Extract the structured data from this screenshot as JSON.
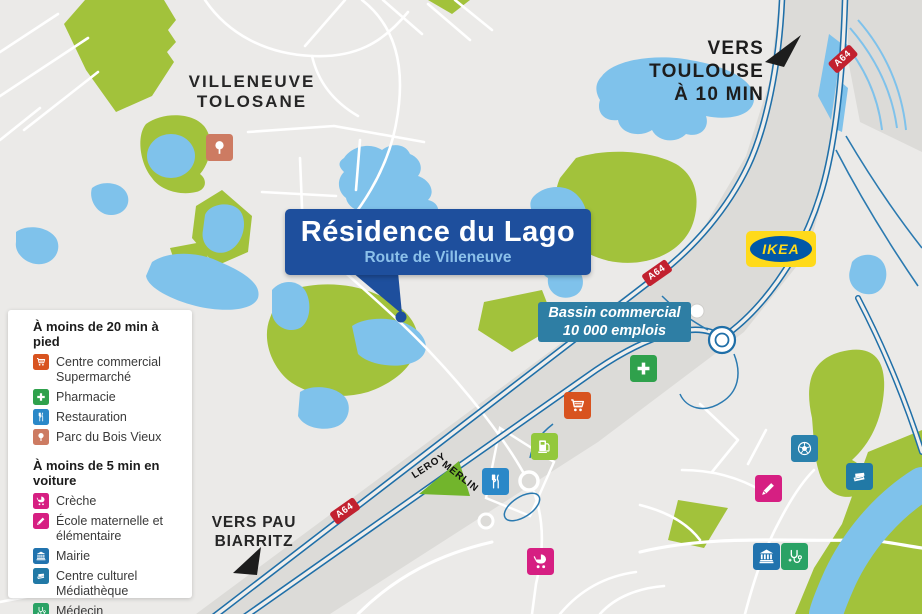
{
  "colors": {
    "land": "#EBEAE8",
    "corridor": "#DCDBD8",
    "water": "#7FC2EB",
    "park": "#A2C23B",
    "road": "#FFFFFF",
    "motorway": "#1F6FA8",
    "ramp": "#2B7AB0",
    "badge_red": "#C2212F",
    "callout_bg": "#1E4F9D",
    "callout_subtitle": "#8BC0EA",
    "bassin_bg": "#2E7EA4",
    "ikea_yellow": "#FFDA1A",
    "ikea_blue": "#0058A8",
    "leroy_green": "#72B52C"
  },
  "callout": {
    "title": "Résidence du Lago",
    "subtitle": "Route de Villeneuve"
  },
  "labels": {
    "city": "VILLENEUVE\nTOLOSANE",
    "toulouse": "VERS TOULOUSE\nÀ 10 MIN",
    "pau": "VERS PAU\nBIARRITZ"
  },
  "bassin": {
    "line1": "Bassin commercial",
    "line2": "10 000 emplois"
  },
  "brands": {
    "ikea": "IKEA",
    "leroy": "LEROY",
    "merlin": "MERLIN"
  },
  "map": {
    "badges": [
      {
        "label": "A64",
        "x": 345,
        "y": 511,
        "rot": -35
      },
      {
        "label": "A64",
        "x": 657,
        "y": 273,
        "rot": -35
      },
      {
        "label": "A64",
        "x": 843,
        "y": 59,
        "rot": -42
      }
    ],
    "markers": [
      {
        "icon": "tree",
        "color": "#CD7B62",
        "x": 206,
        "y": 134
      },
      {
        "icon": "cart",
        "color": "#D8531F",
        "x": 564,
        "y": 392
      },
      {
        "icon": "cross",
        "color": "#2FA14C",
        "x": 630,
        "y": 355
      },
      {
        "icon": "fuel",
        "color": "#93C83D",
        "x": 531,
        "y": 433
      },
      {
        "icon": "restaurant",
        "color": "#2A88C8",
        "x": 482,
        "y": 468
      },
      {
        "icon": "stroller",
        "color": "#D61F82",
        "x": 527,
        "y": 548
      },
      {
        "icon": "ball",
        "color": "#2A81AC",
        "x": 791,
        "y": 435
      },
      {
        "icon": "books",
        "color": "#2179A6",
        "x": 846,
        "y": 463
      },
      {
        "icon": "pencil",
        "color": "#D61F82",
        "x": 755,
        "y": 475
      },
      {
        "icon": "bank",
        "color": "#2173AE",
        "x": 753,
        "y": 543
      },
      {
        "icon": "stethoscope",
        "color": "#2AA265",
        "x": 781,
        "y": 543
      }
    ]
  },
  "legend": {
    "sections": [
      {
        "header": "À moins de 20 min à pied",
        "items": [
          {
            "icon": "cart",
            "color": "#D8531F",
            "label": "Centre commercial\nSupermarché"
          },
          {
            "icon": "cross",
            "color": "#2FA14C",
            "label": "Pharmacie"
          },
          {
            "icon": "restaurant",
            "color": "#2A88C8",
            "label": "Restauration"
          },
          {
            "icon": "tree",
            "color": "#CD7B62",
            "label": "Parc du Bois Vieux"
          }
        ]
      },
      {
        "header": "À moins de 5 min en voiture",
        "items": [
          {
            "icon": "stroller",
            "color": "#D61F82",
            "label": "Crèche"
          },
          {
            "icon": "pencil",
            "color": "#D61F82",
            "label": "École maternelle et\nélémentaire"
          },
          {
            "icon": "bank",
            "color": "#2173AE",
            "label": "Mairie"
          },
          {
            "icon": "books",
            "color": "#2179A6",
            "label": "Centre culturel\nMédiathèque"
          },
          {
            "icon": "stethoscope",
            "color": "#2AA265",
            "label": "Médecin"
          },
          {
            "icon": "ball",
            "color": "#2A81AC",
            "label": "Stade"
          }
        ]
      }
    ]
  }
}
